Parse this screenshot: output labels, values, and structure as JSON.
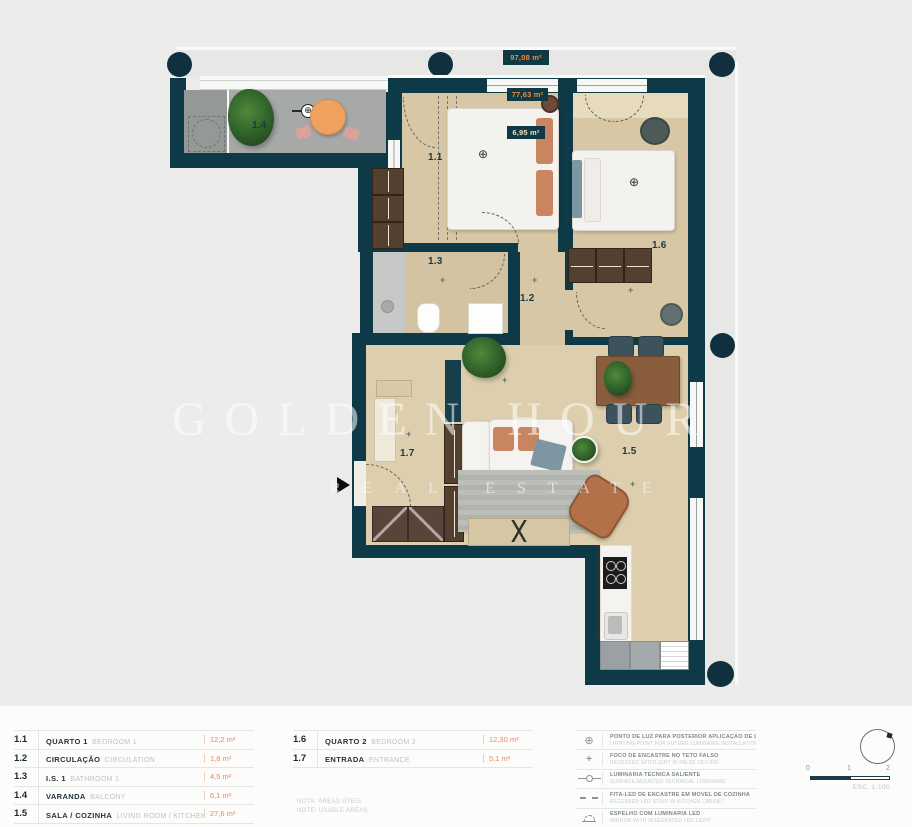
{
  "plan": {
    "badges": {
      "total": "97,08 m²",
      "usable": "77,63 m²",
      "partial": "6,95 m²"
    },
    "room_labels": {
      "r11": "1.1",
      "r12": "1.2",
      "r13": "1.3",
      "r14": "1.4",
      "r15": "1.5",
      "r16": "1.6",
      "r17": "1.7"
    },
    "icons": {
      "crosshair": "⊕",
      "plus": "+",
      "spot": "+"
    }
  },
  "watermark": {
    "line1": "GOLDEN HOUR",
    "line2": "REAL ESTATE"
  },
  "legend": {
    "rooms_col1": [
      {
        "num": "1.1",
        "pt": "QUARTO 1",
        "en": "BEDROOM 1",
        "area": "12,2 m²"
      },
      {
        "num": "1.2",
        "pt": "CIRCULAÇÃO",
        "en": "CIRCULATION",
        "area": "1,8 m²"
      },
      {
        "num": "1.3",
        "pt": "I.S. 1",
        "en": "BATHROOM 1",
        "area": "4,5 m²"
      },
      {
        "num": "1.4",
        "pt": "VARANDA",
        "en": "BALCONY",
        "area": "6,1 m²"
      },
      {
        "num": "1.5",
        "pt": "SALA / COZINHA",
        "en": "LIVING ROOM / KITCHEN",
        "area": "27,6 m²"
      }
    ],
    "rooms_col2": [
      {
        "num": "1.6",
        "pt": "QUARTO 2",
        "en": "BEDROOM 2",
        "area": "12,30 m²"
      },
      {
        "num": "1.7",
        "pt": "ENTRADA",
        "en": "ENTRANCE",
        "area": "5,1 m²"
      }
    ],
    "notes": [
      "NOTA: ÁREAS ÚTEIS",
      "NOTE: USABLE AREAS"
    ],
    "symbols": [
      {
        "name": "light-point-icon",
        "glyph": "⊕",
        "pt": "PONTO DE LUZ PARA POSTERIOR APLICAÇÃO DE LUMINÁRIA",
        "en": "LIGHTING POINT FOR FUTURE LUMINAIRE INSTALLATION"
      },
      {
        "name": "recessed-spotlight-icon",
        "glyph": "+",
        "pt": "FOCO DE ENCASTRE NO TETO FALSO",
        "en": "RECESSED SPOTLIGHT IN FALSE CEILING"
      },
      {
        "name": "surface-luminaire-icon",
        "glyph": "",
        "pt": "LUMINÁRIA TÉCNICA SALIENTE",
        "en": "SURFACE-MOUNTED TECHNICAL LUMINAIRE"
      },
      {
        "name": "led-strip-icon",
        "glyph": "",
        "pt": "FITA-LED DE ENCASTRE EM MÓVEL DE COZINHA",
        "en": "RECESSED LED STRIP IN KITCHEN CABINET"
      },
      {
        "name": "mirror-led-icon",
        "glyph": "",
        "pt": "ESPELHO COM LUMINÁRIA LED",
        "en": "MIRROR WITH INTEGRATED LED LIGHT"
      }
    ]
  },
  "scale": {
    "t0": "0",
    "t1": "1",
    "t2": "2",
    "label": "ESC. 1:100"
  },
  "colors": {
    "wall": "#0e3a48",
    "accent_orange": "#f08a3e",
    "floor_wood": "#d8c7a5",
    "balcony_gray": "#a6a9a8"
  }
}
